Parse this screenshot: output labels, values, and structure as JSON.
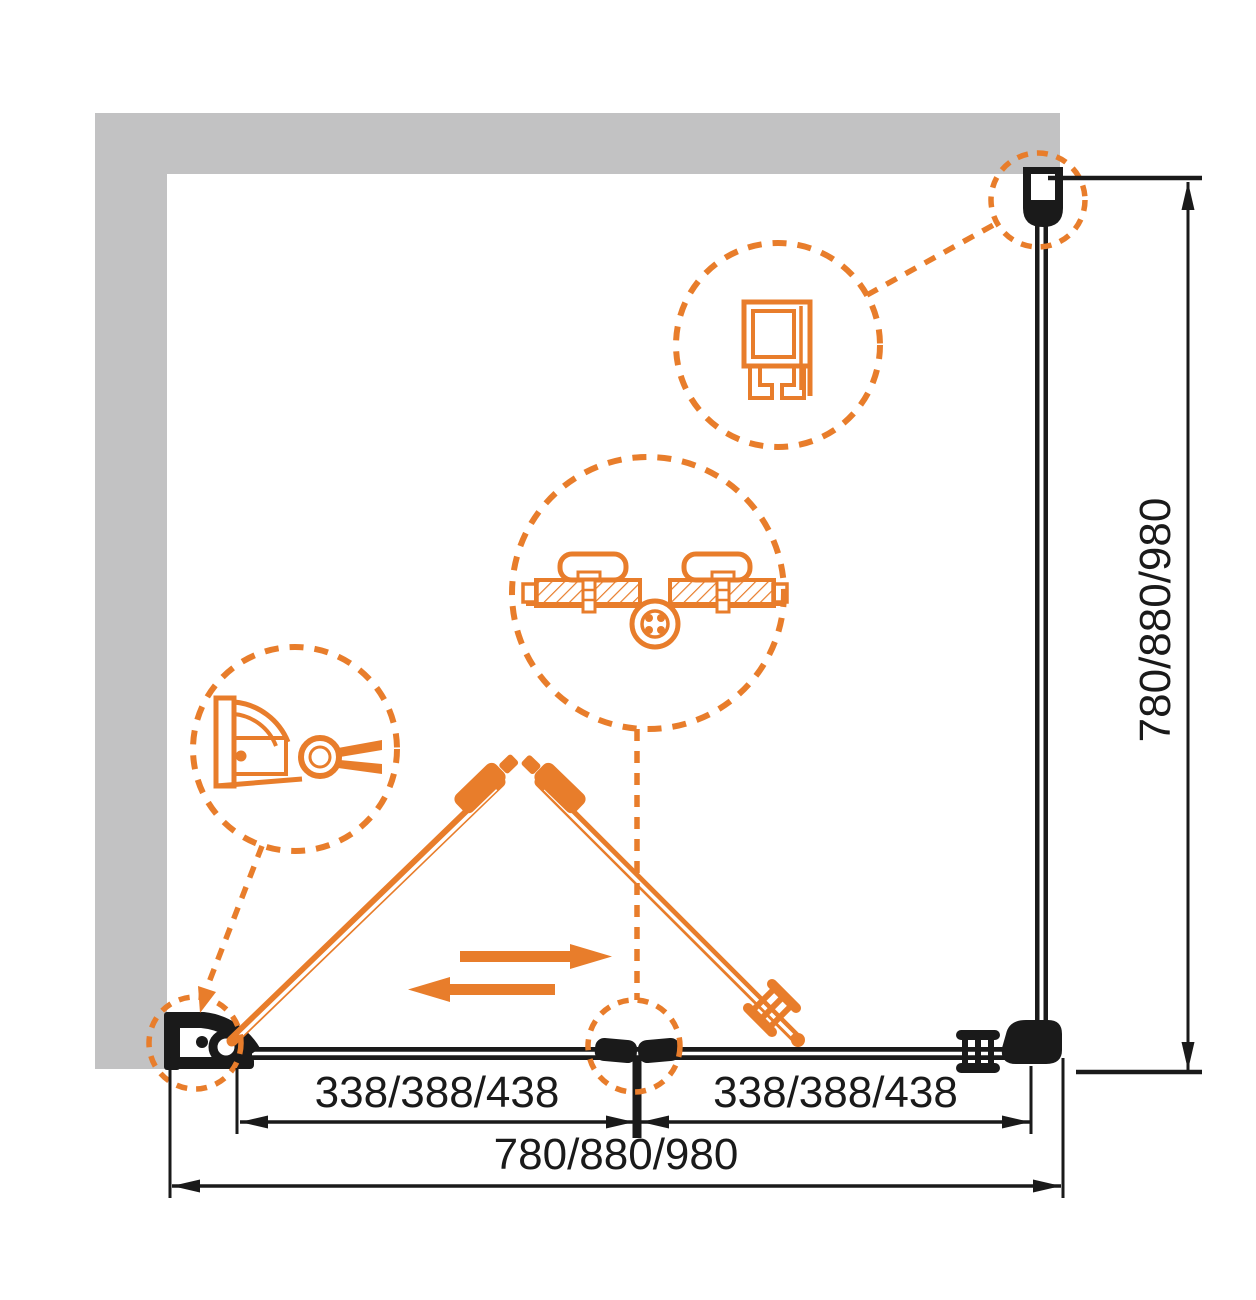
{
  "drawing": {
    "type": "shower-enclosure-installation-diagram",
    "dimensions": {
      "segment_left": "338/388/438",
      "segment_right": "338/388/438",
      "overall_width": "780/880/980",
      "side_height": "780/880/980"
    },
    "colors": {
      "accent_orange": "#e87d2b",
      "line_black": "#1a1a1a",
      "wall_gray": "#c2c2c3"
    },
    "details": {
      "top_callout": "wall-profile-cross-section",
      "middle_callout": "bifold-hinge-connector",
      "left_callout": "wall-pivot-bracket"
    },
    "annotations": {
      "icons": [
        "slide-right-arrow",
        "slide-left-arrow"
      ]
    }
  }
}
